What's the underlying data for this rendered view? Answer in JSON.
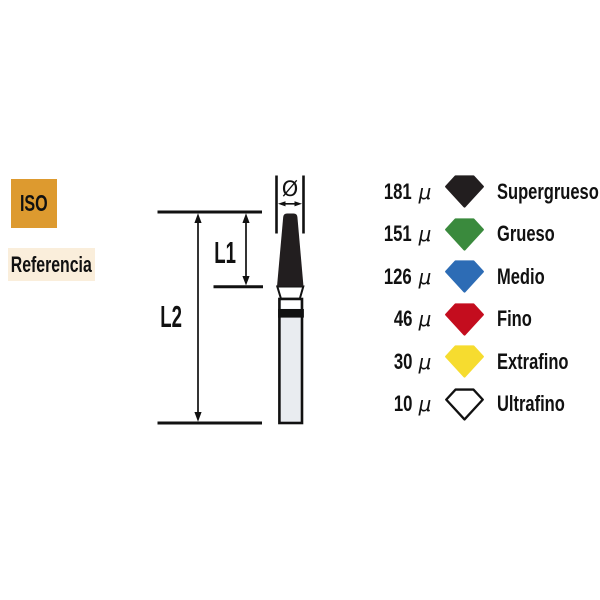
{
  "badges": {
    "iso": "ISO",
    "referencia": "Referencia"
  },
  "diagram": {
    "diameter_symbol": "Ø",
    "l1_label": "L1",
    "l2_label": "L2"
  },
  "legend": {
    "rows": [
      {
        "value": "181",
        "unit": "μ",
        "label": "Supergrueso",
        "fill": "#221e1f",
        "stroke": "#221e1f"
      },
      {
        "value": "151",
        "unit": "μ",
        "label": "Grueso",
        "fill": "#3a8a3d",
        "stroke": "#3a8a3d"
      },
      {
        "value": "126",
        "unit": "μ",
        "label": "Medio",
        "fill": "#2d6cb5",
        "stroke": "#2d6cb5"
      },
      {
        "value": "46",
        "unit": "μ",
        "label": "Fino",
        "fill": "#c40d1e",
        "stroke": "#c40d1e"
      },
      {
        "value": "30",
        "unit": "μ",
        "label": "Extrafino",
        "fill": "#f6dc2f",
        "stroke": "#f6dc2f"
      },
      {
        "value": "10",
        "unit": "μ",
        "label": "Ultrafino",
        "fill": "#ffffff",
        "stroke": "#111111"
      }
    ]
  },
  "colors": {
    "iso_badge_bg": "#dd9a2f",
    "referencia_badge_bg": "#faeedb",
    "line_color": "#111111",
    "bur_tip": "#221e1f",
    "bur_shank_fill": "#e9ecf0"
  }
}
